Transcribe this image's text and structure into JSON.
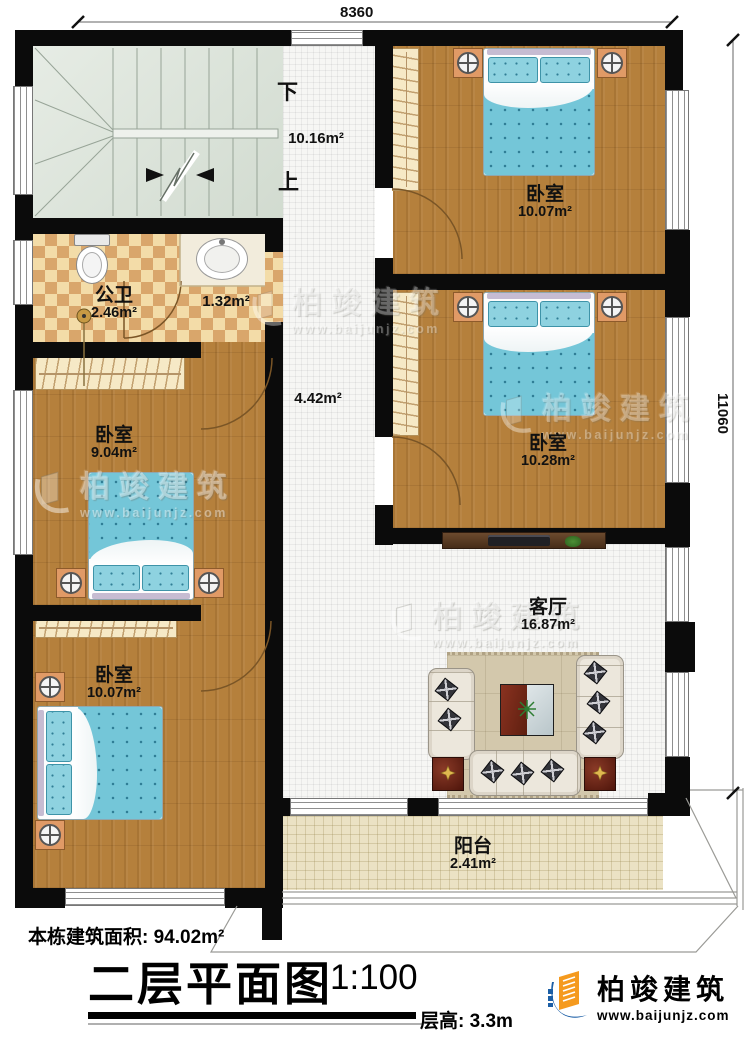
{
  "plan": {
    "dimensions": {
      "width_mm": "8360",
      "height_mm": "11060"
    },
    "stairs": {
      "down": "下",
      "up": "上",
      "area": "10.16m²"
    },
    "bathroom": {
      "name": "公卫",
      "area": "2.46m²"
    },
    "wash_area": {
      "area": "1.32m²"
    },
    "hallway": {
      "area": "4.42m²"
    },
    "bedroom_top_right": {
      "name": "卧室",
      "area": "10.07m²"
    },
    "bedroom_mid_right": {
      "name": "卧室",
      "area": "10.28m²"
    },
    "bedroom_mid_left": {
      "name": "卧室",
      "area": "9.04m²"
    },
    "bedroom_bottom_left": {
      "name": "卧室",
      "area": "10.07m²"
    },
    "living_room": {
      "name": "客厅",
      "area": "16.87m²"
    },
    "balcony": {
      "name": "阳台",
      "area": "2.41m²"
    }
  },
  "title_block": {
    "building_area": "本栋建筑面积: 94.02m²",
    "title": "二层平面图",
    "scale": "1:100",
    "floor_height": "层高: 3.3m"
  },
  "brand": {
    "name": "柏竣建筑",
    "website": "www.baijunjz.com"
  },
  "watermark": {
    "name": "柏竣建筑",
    "website": "www.baijunjz.com"
  },
  "colors": {
    "wall": "#0b0b0b",
    "wood_floor": "#b5803c",
    "stair_floor": "#dee6dc",
    "tile_floor": "#f6f6f4",
    "balcony_floor": "#ebe2c4",
    "checker_tile": "#d9a66b",
    "bed_blue": "#74c6d8",
    "logo_blue": "#1b5ea6",
    "logo_orange": "#f59a1e"
  }
}
